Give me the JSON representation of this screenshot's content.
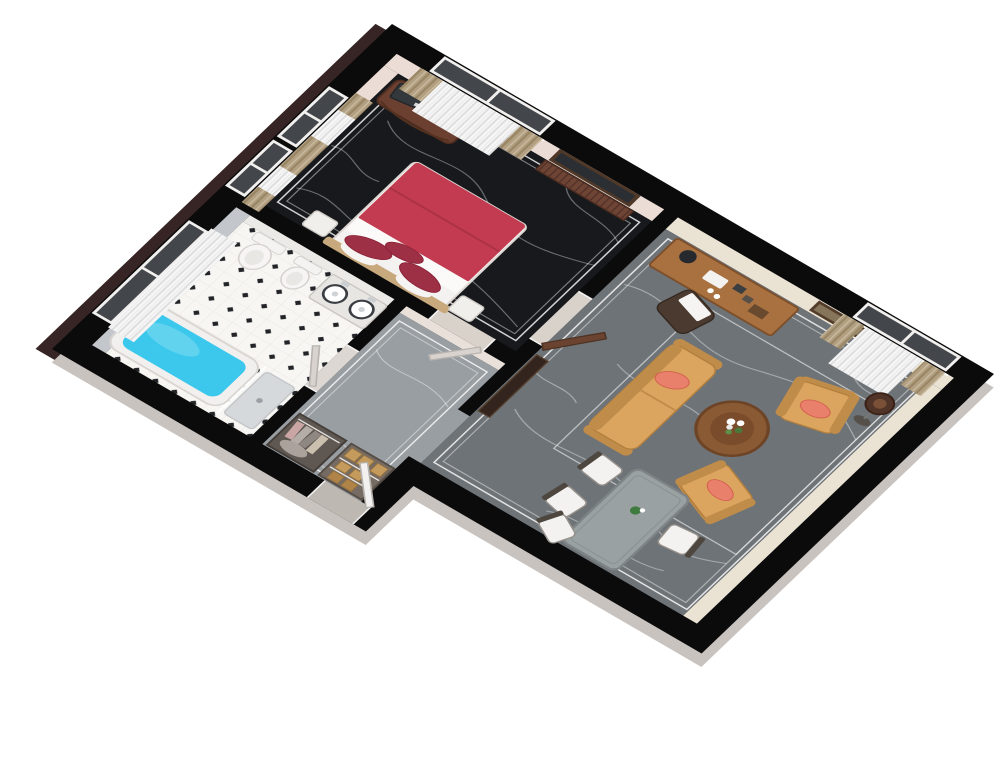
{
  "scene": {
    "kind": "3d-floor-plan-cutaway-render",
    "description": "Isometric 3D cutaway floor plan of a one-bedroom suite, rotated, on white background",
    "rooms": [
      {
        "id": "bedroom",
        "label": "bedroom",
        "floor_finish": "black marble with white veining"
      },
      {
        "id": "bathroom",
        "label": "bathroom",
        "floor_finish": "white tile with black diamond accents"
      },
      {
        "id": "hallway",
        "label": "entry hallway",
        "floor_finish": "gray marble"
      },
      {
        "id": "living-room",
        "label": "living and dining room",
        "floor_finish": "gray marble with white veining"
      }
    ],
    "furniture": {
      "bedroom": [
        "double-bed-red-duvet",
        "bolster-pillows",
        "nightstand",
        "tv-panel",
        "tv-stand",
        "window-curtains-left-1",
        "window-curtains-left-2",
        "window-curtains-top",
        "radiator",
        "wall-mirror"
      ],
      "bathroom": [
        "bathtub-with-water",
        "shower-tray",
        "glass-screen",
        "toilet",
        "bidet",
        "double-sink-vanity",
        "window-white-curtain"
      ],
      "hallway": [
        "closet-hanging-clothes",
        "closet-wicker-baskets",
        "entry-door-open"
      ],
      "living_room": [
        "writing-desk",
        "desk-chair-with-towel",
        "wall-picture",
        "window-curtains",
        "floor-lamp",
        "loveseat",
        "armchair-1",
        "armchair-2",
        "round-coffee-table-flowers",
        "dining-table",
        "dining-chairs-x4",
        "sideboard",
        "open-door-leaf"
      ]
    }
  },
  "colors": {
    "background": "#ffffff",
    "wall_cut": "#0b0b0c",
    "outer_face_light": "#c9c3bf",
    "outer_face_dark": "#362524",
    "wall_face_bedroom": "#ecdcd6",
    "wall_face_living": "#eae3d4",
    "wall_face_bath": "#c3c7cb",
    "wall_face_white": "#eceae6",
    "floor_bedroom": "#17191d",
    "floor_living": "#6e7377",
    "floor_hall": "#999ea3",
    "tile_white": "#f7f6f3",
    "tile_dot": "#222428",
    "inlay_line": "#ffffff",
    "glass": "#43474b",
    "curtain_tan": "#b3a083",
    "curtain_sheer": "#f6f6f6",
    "radiator": "#6e4434",
    "bed_blanket": "#c23b50",
    "bed_pillow": "#9e3046",
    "bed_white": "#f4f2f0",
    "headboard": "#c8a97e",
    "water": "#3cc8ec",
    "fixture_white": "#f4f3f1",
    "counter": "#e8e6e2",
    "sofa": "#dca55f",
    "sofa_dark": "#c08c49",
    "cushion": "#e8806c",
    "coffee_table": "#8a5a34",
    "desk": "#a9713f",
    "dining_table": "#9aa1a3",
    "chair_white": "#f3f2f0",
    "door_brown": "#6a4430",
    "lamp_shade": "#503428",
    "closet_basket": "#c59a5d",
    "tv": "#33383c"
  }
}
